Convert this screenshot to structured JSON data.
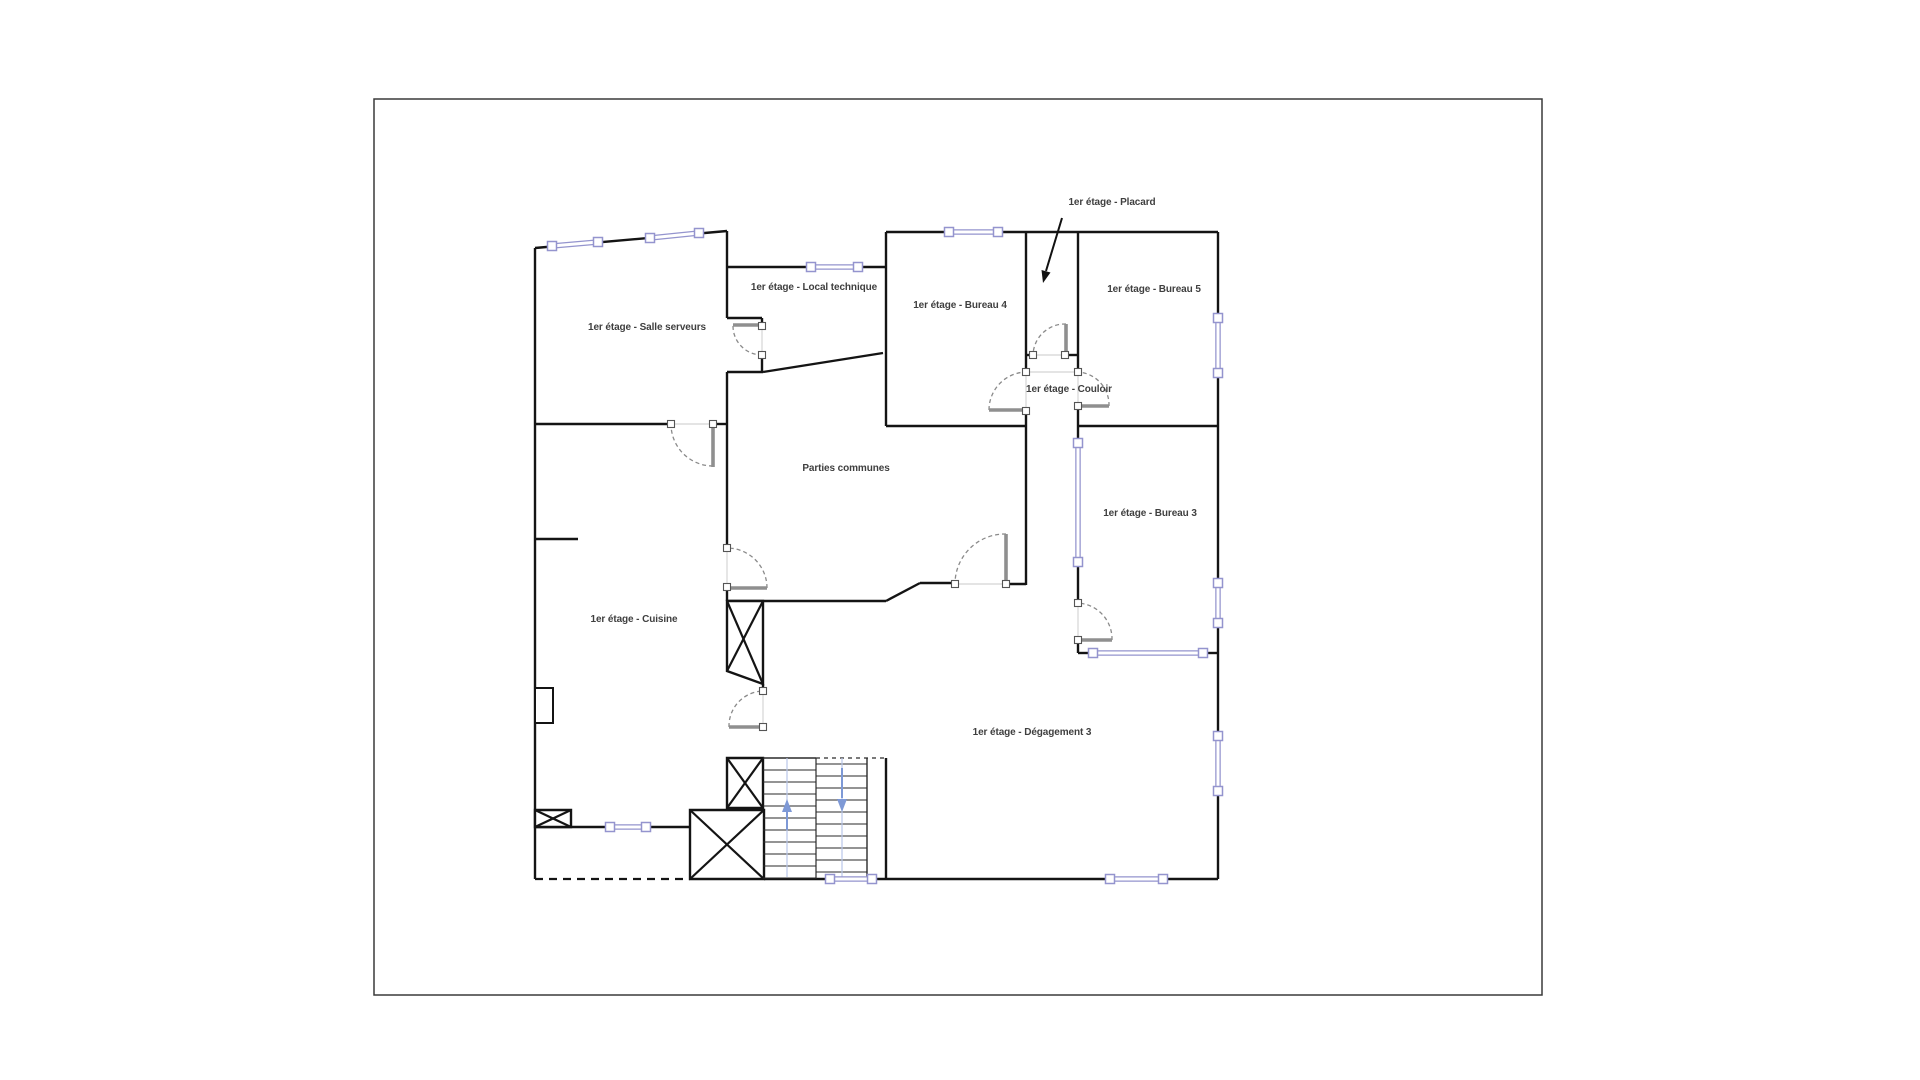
{
  "canvas": {
    "width": 1920,
    "height": 1080,
    "background": "#ffffff"
  },
  "page_border": {
    "x": 374,
    "y": 99,
    "width": 1168,
    "height": 896,
    "color": "#3a3a3a"
  },
  "colors": {
    "wall": "#141414",
    "window": "#9494ce",
    "window_fill": "#ffffff",
    "door_arc": "#8a8a8a",
    "door_leaf": "#8f8f8f",
    "opening": "#dcdcdc",
    "jamb_border": "#555555",
    "stair_line": "#2a2a2a",
    "stair_guide": "#b9c6e8",
    "stair_arrow": "#7e99d6",
    "label": "#3f3f3f",
    "annotation_arrow": "#111111"
  },
  "rooms": [
    {
      "id": "salle-serveurs",
      "label": "1er étage - Salle serveurs",
      "x": 647,
      "y": 330
    },
    {
      "id": "local-technique",
      "label": "1er étage - Local technique",
      "x": 814,
      "y": 290
    },
    {
      "id": "bureau-4",
      "label": "1er étage - Bureau 4",
      "x": 960,
      "y": 308
    },
    {
      "id": "bureau-5",
      "label": "1er étage - Bureau 5",
      "x": 1154,
      "y": 292
    },
    {
      "id": "couloir",
      "label": "1er étage - Couloir",
      "x": 1069,
      "y": 392
    },
    {
      "id": "bureau-3",
      "label": "1er étage - Bureau 3",
      "x": 1150,
      "y": 516
    },
    {
      "id": "parties-communes",
      "label": "Parties communes",
      "x": 846,
      "y": 471
    },
    {
      "id": "cuisine",
      "label": "1er étage - Cuisine",
      "x": 634,
      "y": 622
    },
    {
      "id": "degagement-3",
      "label": "1er étage - Dégagement 3",
      "x": 1032,
      "y": 735
    }
  ],
  "annotation": {
    "label": "1er étage - Placard",
    "x": 1112,
    "y": 205,
    "arrow_line": [
      1062,
      218,
      1046,
      271
    ],
    "arrow_head": [
      [
        1043,
        283
      ],
      [
        1041.5,
        270
      ],
      [
        1050.5,
        272.5
      ]
    ]
  },
  "walls": [
    [
      535,
      248,
      727,
      231
    ],
    [
      727,
      231,
      727,
      318
    ],
    [
      727,
      318,
      762,
      318
    ],
    [
      762,
      318,
      762,
      326
    ],
    [
      762,
      355,
      762,
      372
    ],
    [
      727,
      372,
      763,
      372
    ],
    [
      763,
      372,
      883,
      353
    ],
    [
      727,
      267,
      886,
      267
    ],
    [
      886,
      232,
      886,
      426
    ],
    [
      886,
      232,
      1218,
      232
    ],
    [
      1218,
      232,
      1218,
      879
    ],
    [
      764,
      879,
      1218,
      879
    ],
    [
      535,
      248,
      535,
      879
    ],
    [
      535,
      424,
      671,
      424
    ],
    [
      713,
      424,
      727,
      424
    ],
    [
      727,
      372,
      727,
      548
    ],
    [
      727,
      587,
      727,
      601
    ],
    [
      727,
      601,
      886,
      601
    ],
    [
      886,
      601,
      920,
      583
    ],
    [
      920,
      583,
      955,
      583
    ],
    [
      1006,
      584,
      1026,
      584
    ],
    [
      1026,
      232,
      1026,
      372
    ],
    [
      1026,
      411,
      1026,
      585
    ],
    [
      1078,
      232,
      1078,
      372
    ],
    [
      1078,
      406,
      1078,
      426
    ],
    [
      1026,
      355,
      1033,
      355
    ],
    [
      1065,
      355,
      1078,
      355
    ],
    [
      886,
      426,
      1026,
      426
    ],
    [
      1078,
      426,
      1218,
      426
    ],
    [
      1078,
      426,
      1078,
      443
    ],
    [
      1078,
      562,
      1078,
      603
    ],
    [
      1078,
      640,
      1078,
      653
    ],
    [
      1078,
      653,
      1093,
      653
    ],
    [
      1203,
      653,
      1218,
      653
    ],
    [
      535,
      539,
      578,
      539
    ],
    [
      535,
      827,
      690,
      827
    ],
    [
      763,
      684,
      763,
      691
    ],
    [
      886,
      758,
      886,
      879
    ]
  ],
  "dashed_walls": [
    [
      535,
      879,
      690,
      879
    ]
  ],
  "opening_lines": [
    [
      762,
      326,
      762,
      355
    ],
    [
      671,
      424,
      713,
      424
    ],
    [
      727,
      548,
      727,
      587
    ],
    [
      763,
      691,
      763,
      727
    ],
    [
      955,
      584,
      1006,
      584
    ],
    [
      1026,
      372,
      1026,
      411
    ],
    [
      1078,
      372,
      1078,
      406
    ],
    [
      1033,
      355,
      1065,
      355
    ],
    [
      1078,
      603,
      1078,
      640
    ],
    [
      1026,
      372,
      1078,
      372
    ]
  ],
  "windows": [
    {
      "id": "w-salle-1",
      "x1": 552,
      "y1": 246,
      "x2": 598,
      "y2": 242
    },
    {
      "id": "w-salle-2",
      "x1": 650,
      "y1": 238,
      "x2": 699,
      "y2": 233
    },
    {
      "id": "w-local",
      "x1": 811,
      "y1": 267,
      "x2": 858,
      "y2": 267
    },
    {
      "id": "w-bureau4",
      "x1": 949,
      "y1": 232,
      "x2": 998,
      "y2": 232
    },
    {
      "id": "w-right-1",
      "x1": 1218,
      "y1": 318,
      "x2": 1218,
      "y2": 373
    },
    {
      "id": "w-right-2",
      "x1": 1218,
      "y1": 583,
      "x2": 1218,
      "y2": 623
    },
    {
      "id": "w-right-3",
      "x1": 1218,
      "y1": 736,
      "x2": 1218,
      "y2": 791
    },
    {
      "id": "w-bureau3-l",
      "x1": 1078,
      "y1": 443,
      "x2": 1078,
      "y2": 562
    },
    {
      "id": "w-bureau3-b",
      "x1": 1093,
      "y1": 653,
      "x2": 1203,
      "y2": 653
    },
    {
      "id": "w-bottom-1",
      "x1": 830,
      "y1": 879,
      "x2": 872,
      "y2": 879
    },
    {
      "id": "w-bottom-2",
      "x1": 1110,
      "y1": 879,
      "x2": 1163,
      "y2": 879
    },
    {
      "id": "w-cuisine",
      "x1": 610,
      "y1": 827,
      "x2": 646,
      "y2": 827
    }
  ],
  "doors": [
    {
      "id": "door-salle-serveurs",
      "leaf": [
        733,
        325,
        762,
        325
      ],
      "arc": "M733,326 A29,29 0 0 0 762,355",
      "jambs": [
        [
          762,
          326
        ],
        [
          762,
          355
        ]
      ]
    },
    {
      "id": "door-cuisine-haut",
      "leaf": [
        713,
        427,
        713,
        467
      ],
      "arc": "M713,466 A42,42 0 0 1 671,424",
      "jambs": [
        [
          671,
          424
        ],
        [
          713,
          424
        ]
      ]
    },
    {
      "id": "door-parties-ouest",
      "leaf": [
        728,
        588,
        767,
        588
      ],
      "arc": "M767,588 A40,40 0 0 0 727,548",
      "jambs": [
        [
          727,
          548
        ],
        [
          727,
          587
        ]
      ]
    },
    {
      "id": "door-escalier",
      "leaf": [
        729,
        727,
        762,
        727
      ],
      "arc": "M729,727 A35,35 0 0 1 763,691",
      "jambs": [
        [
          763,
          691
        ],
        [
          763,
          727
        ]
      ]
    },
    {
      "id": "door-parties-sud",
      "leaf": [
        1006,
        534,
        1006,
        583
      ],
      "arc": "M1006,534 A50,50 0 0 0 955,584",
      "jambs": [
        [
          955,
          584
        ],
        [
          1006,
          584
        ]
      ]
    },
    {
      "id": "door-bureau-4",
      "leaf": [
        989,
        410,
        1025,
        410
      ],
      "arc": "M989,410 A38,38 0 0 1 1026,372",
      "jambs": [
        [
          1026,
          372
        ],
        [
          1026,
          411
        ]
      ]
    },
    {
      "id": "door-bureau-5",
      "leaf": [
        1079,
        406,
        1109,
        406
      ],
      "arc": "M1109,406 A33,33 0 0 0 1078,372",
      "jambs": [
        [
          1078,
          372
        ],
        [
          1078,
          406
        ]
      ]
    },
    {
      "id": "door-placard",
      "leaf": [
        1066,
        324,
        1066,
        354
      ],
      "arc": "M1066,324 A32,32 0 0 0 1033,355",
      "jambs": [
        [
          1033,
          355
        ],
        [
          1065,
          355
        ]
      ]
    },
    {
      "id": "door-bureau-3",
      "leaf": [
        1079,
        640,
        1112,
        640
      ],
      "arc": "M1112,640 A36,36 0 0 0 1078,603",
      "jambs": [
        [
          1078,
          603
        ],
        [
          1078,
          640
        ]
      ]
    }
  ],
  "crossed_boxes": [
    {
      "id": "box-gaine-gauche",
      "points": [
        [
          535,
          810
        ],
        [
          571,
          810
        ],
        [
          571,
          827
        ],
        [
          535,
          827
        ]
      ]
    },
    {
      "id": "box-ascenseur-bas",
      "points": [
        [
          690,
          810
        ],
        [
          764,
          810
        ],
        [
          764,
          879
        ],
        [
          690,
          879
        ]
      ]
    },
    {
      "id": "box-gaine-escalier",
      "points": [
        [
          727,
          758
        ],
        [
          763,
          758
        ],
        [
          763,
          808
        ],
        [
          727,
          808
        ]
      ]
    },
    {
      "id": "box-ascenseur-haut",
      "points": [
        [
          727,
          601
        ],
        [
          763,
          601
        ],
        [
          763,
          684
        ],
        [
          727,
          671
        ]
      ]
    }
  ],
  "fixtures": [
    {
      "id": "placard-mural",
      "x": 535,
      "y": 688,
      "w": 18,
      "h": 35
    }
  ],
  "stairs": {
    "x_left": 763,
    "x_mid": 816,
    "x_right": 867,
    "x_wall": 886,
    "y_top": 758,
    "y_bottom": 879,
    "tread_step": 12,
    "guides": [
      787,
      842
    ],
    "top_solid": [
      763,
      758,
      816,
      758
    ],
    "top_dashed": [
      816,
      758,
      886,
      758
    ],
    "up_arrow": {
      "stem": [
        787,
        830,
        787,
        810
      ],
      "head": [
        [
          787,
          799
        ],
        [
          782,
          812
        ],
        [
          792,
          812
        ]
      ]
    },
    "down_arrow": {
      "stem": [
        842,
        768,
        842,
        798
      ],
      "head": [
        [
          842,
          812
        ],
        [
          837,
          799
        ],
        [
          847,
          799
        ]
      ]
    }
  }
}
